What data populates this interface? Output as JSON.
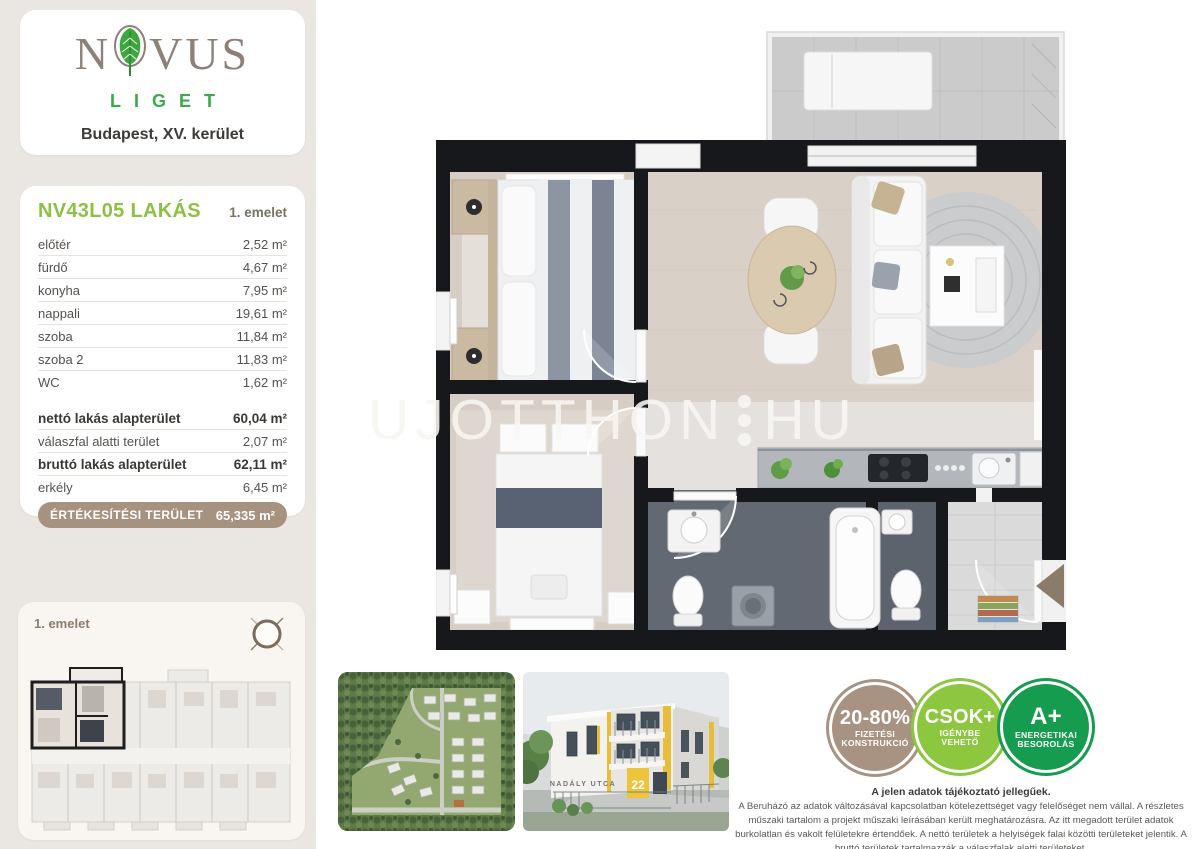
{
  "brand": {
    "name": "NOVUS",
    "name_before_leaf": "N",
    "name_after_leaf": "VUS",
    "subname": "LIGET",
    "location": "Budapest, XV. kerület"
  },
  "unit": {
    "code": "NV43L05 LAKÁS",
    "floor": "1. emelet"
  },
  "rooms": [
    {
      "label": "előtér",
      "value": "2,52 m²"
    },
    {
      "label": "fürdő",
      "value": "4,67 m²"
    },
    {
      "label": "konyha",
      "value": "7,95 m²"
    },
    {
      "label": "nappali",
      "value": "19,61 m²"
    },
    {
      "label": "szoba",
      "value": "11,84 m²"
    },
    {
      "label": "szoba 2",
      "value": "11,83 m²"
    },
    {
      "label": "WC",
      "value": "1,62 m²"
    }
  ],
  "summary": [
    {
      "label": "nettó lakás alapterület",
      "value": "60,04 m²"
    },
    {
      "label": "válaszfal alatti terület",
      "value": "2,07 m²"
    },
    {
      "label": "bruttó lakás alapterület",
      "value": "62,11 m²"
    },
    {
      "label": "erkély",
      "value": "6,45 m²"
    }
  ],
  "sale": {
    "label": "ÉRTÉKESÍTÉSI TERÜLET",
    "value": "65,335 m²"
  },
  "overview": {
    "floor_label": "1. emelet"
  },
  "watermark": {
    "left": "UJOTTHON",
    "right": "HU"
  },
  "building": {
    "street": "NADÁLY UTCA",
    "number": "22"
  },
  "badges": [
    {
      "line1": "20-80%",
      "line2": "FIZETÉSI",
      "line3": "KONSTRUKCIÓ",
      "color": "#a89382"
    },
    {
      "line1": "CSOK+",
      "line2": "IGÉNYBE",
      "line3": "VEHETŐ",
      "color": "#8dc63f"
    },
    {
      "line1": "A+",
      "line2": "ENERGETIKAI",
      "line3": "BESOROLÁS",
      "color": "#169c4e"
    }
  ],
  "disclaimer": {
    "title": "A jelen adatok tájékoztató jellegűek.",
    "body": "A Beruházó az adatok változásával kapcsolatban kötelezettséget vagy felelőséget nem vállal. A részletes műszaki tartalom a projekt műszaki leírásában került meghatározásra. Az itt megadott terület adatok burkolatlan és vakolt felületekre értendőek. A nettó területek a helyiségek falai közötti területeket jelentik. A bruttó területek tartalmazzák a válaszfalak alatti területeket."
  },
  "colors": {
    "accent_green": "#8dc043",
    "liget_green": "#3fa84c",
    "taupe": "#a6927f",
    "csok_green": "#8dc63f",
    "energy_green": "#169c4e"
  }
}
